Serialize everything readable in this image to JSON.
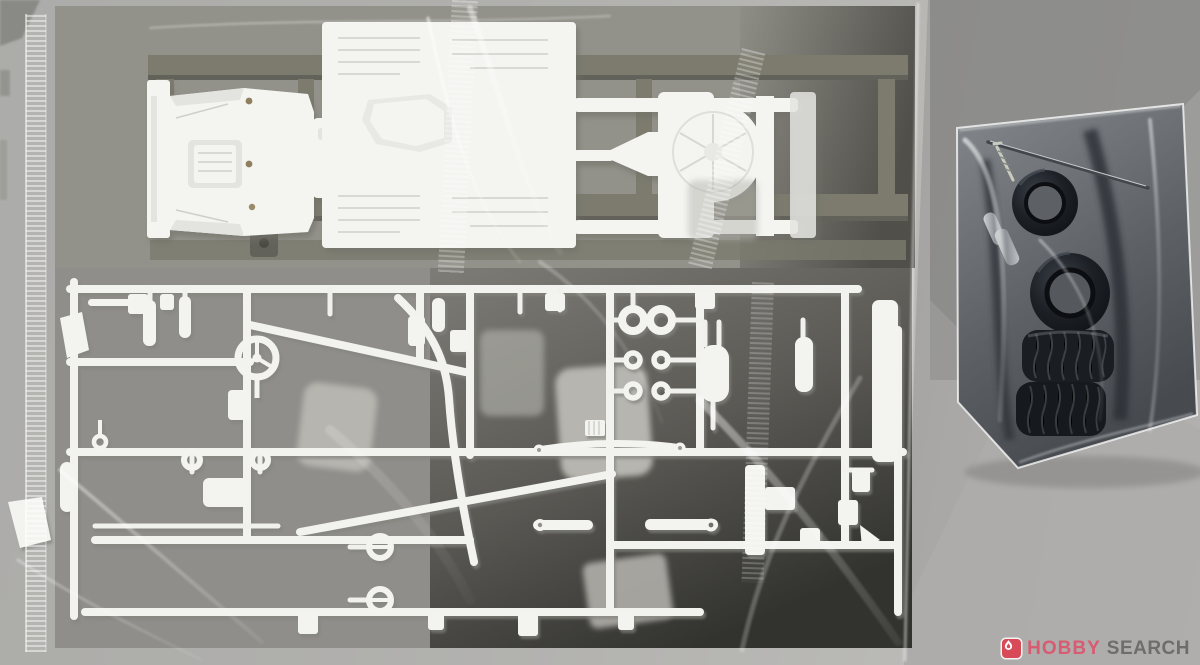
{
  "watermark": {
    "icon": "flame-icon",
    "brand": "HOBBY",
    "suffix": "SEARCH",
    "colors": {
      "icon_bg": "#d84a58",
      "brand": "#d85b72",
      "suffix": "#6d6d6d"
    }
  },
  "scene": {
    "description": "Top-down photo of model kit box contents on a gray surface: a large clear bag holding a white chassis part over a gray-olive sprue and a large white sprue of small parts, plus a small clear bag with four black rubber tires, a long metal axle rod, a screw and two metal tube spacers.",
    "main_bag": {
      "label": "clear-bag-white-sprues",
      "items": [
        {
          "name": "chassis-underbody-part",
          "color": "#f4f4f1"
        },
        {
          "name": "olive-gray-sprue",
          "color": "#7c7b6e"
        },
        {
          "name": "white-parts-sprue",
          "color": "#f2f2ef",
          "parts": [
            "steering-wheel",
            "muffler",
            "leaf-spring",
            "washers",
            "rings",
            "exhaust-pipe",
            "suspension-arms",
            "brackets",
            "blocks"
          ]
        }
      ]
    },
    "accessory_bag": {
      "label": "clear-bag-tires-and-metal",
      "items": [
        {
          "name": "rubber-tires",
          "count": 4,
          "color": "#171a1e"
        },
        {
          "name": "metal-axle-rod",
          "color": "#43474c"
        },
        {
          "name": "screw",
          "color": "#c9cbc0"
        },
        {
          "name": "metal-tubes",
          "count": 2,
          "color": "#a9aeb2"
        }
      ]
    }
  }
}
